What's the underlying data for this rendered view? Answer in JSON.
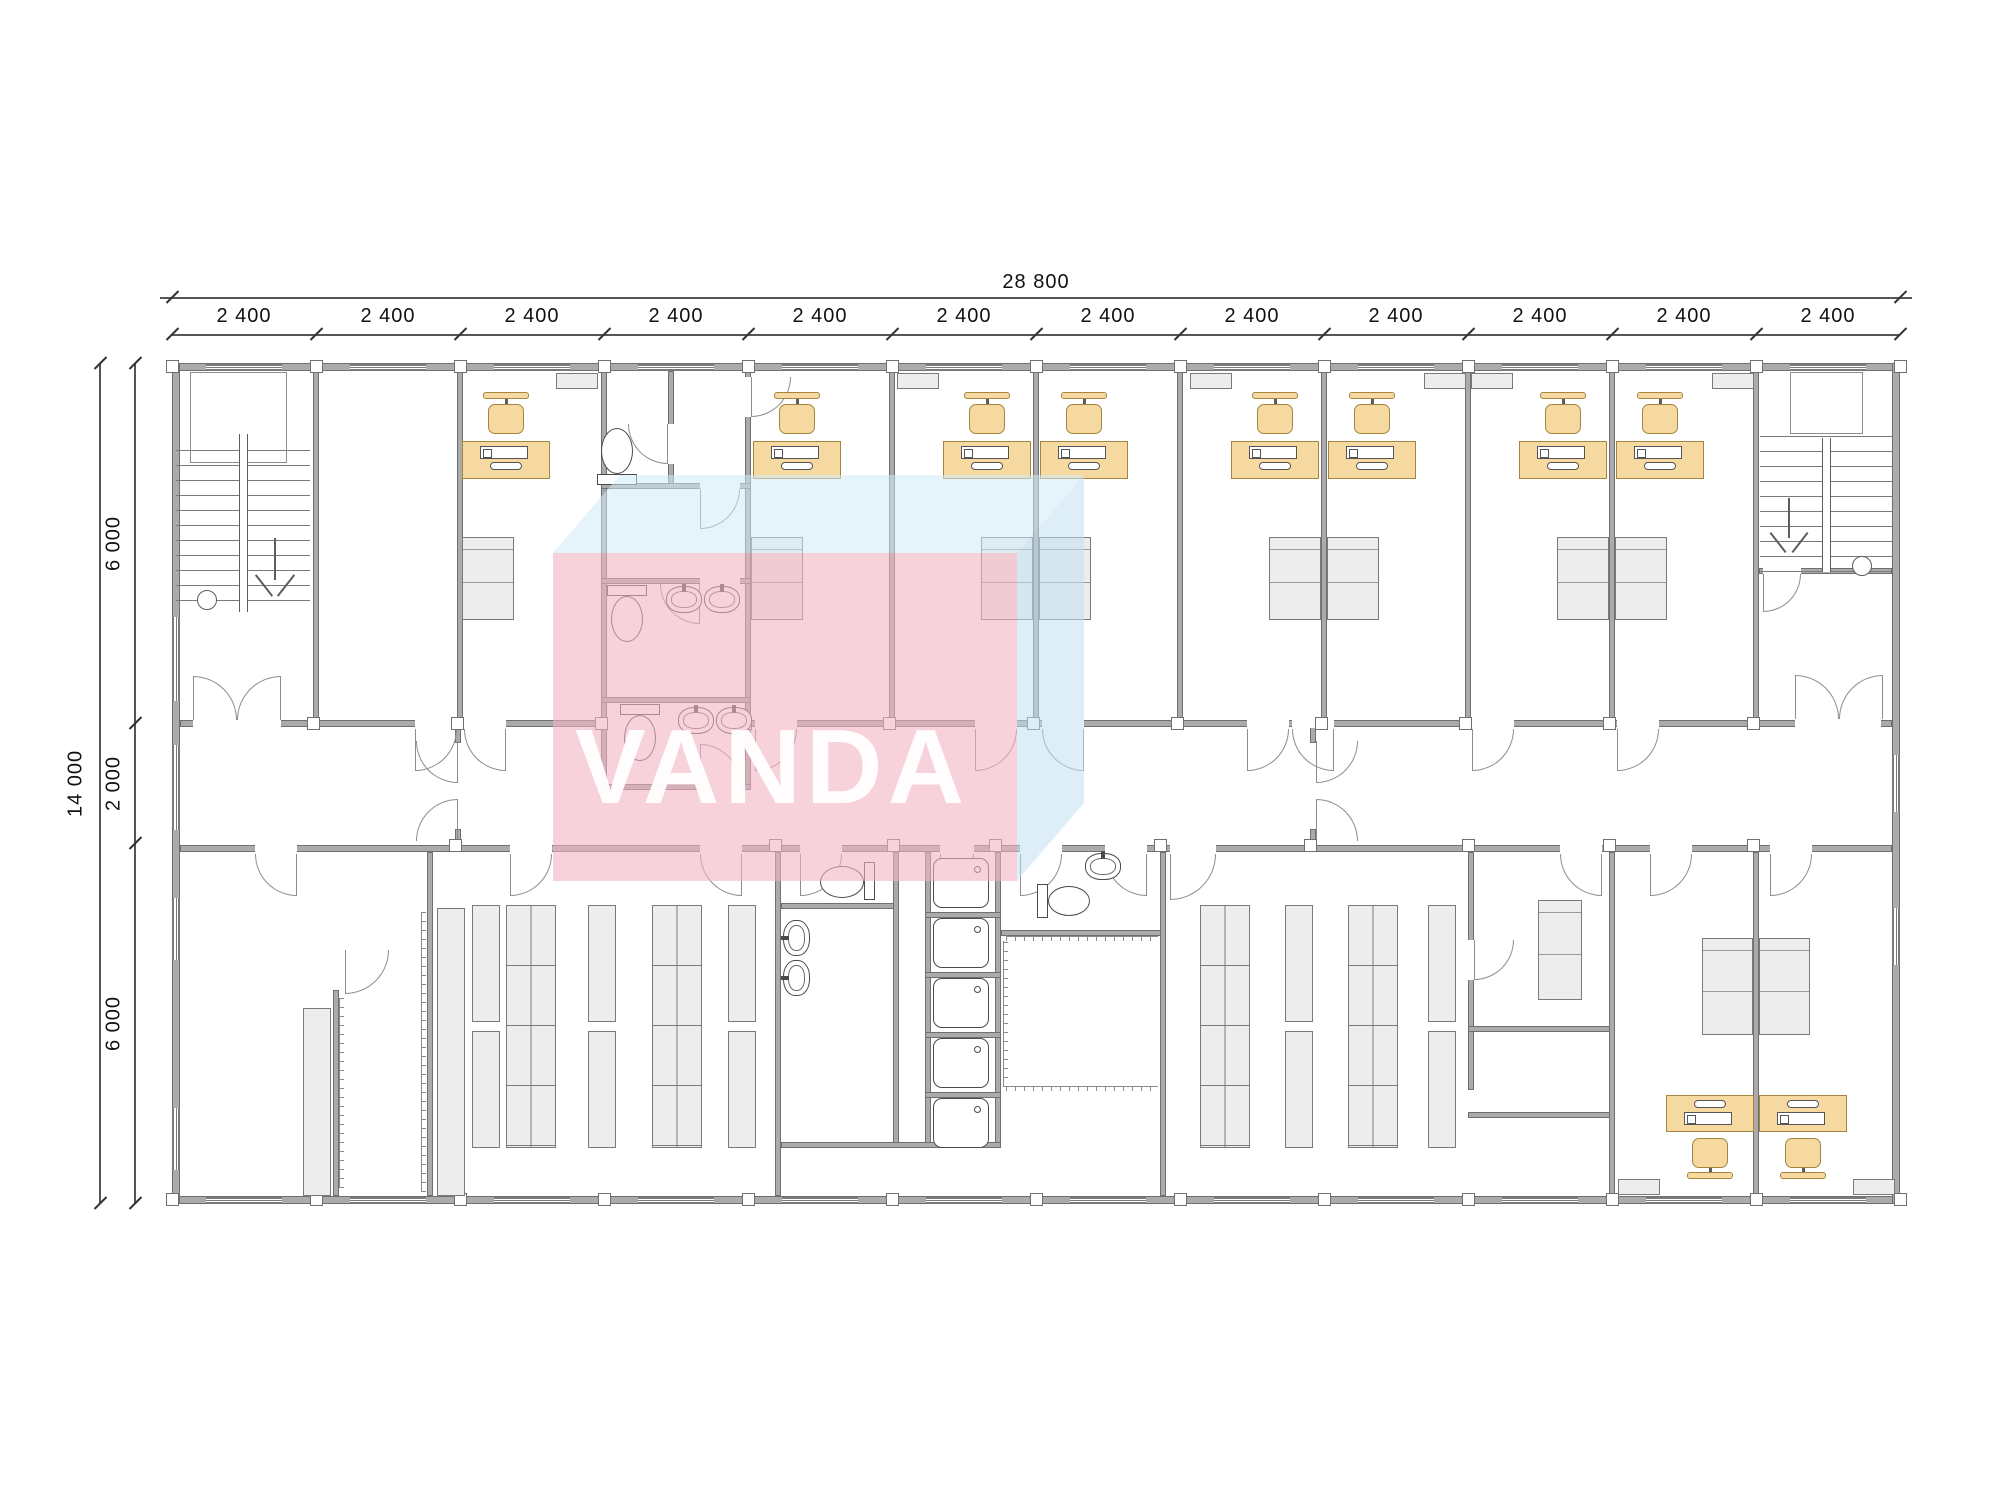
{
  "dimensions": {
    "total_width_label": "28 800",
    "width_segment_labels": [
      "2 400",
      "2 400",
      "2 400",
      "2 400",
      "2 400",
      "2 400",
      "2 400",
      "2 400",
      "2 400",
      "2 400",
      "2 400",
      "2 400"
    ],
    "total_height_label": "14 000",
    "height_segment_labels": [
      "6 000",
      "2 000",
      "6 000"
    ]
  },
  "watermark": {
    "text": "VANDA",
    "front_color": "#f3b4c2",
    "top_color": "#cfe9f7",
    "side_color": "#c3e0f2",
    "text_color": "#ffffff"
  },
  "colors": {
    "wall": "#ababab",
    "wall_edge": "#6f6f6f",
    "furniture_wood": "#f5d9a0",
    "furniture_wood_edge": "#a3853e",
    "furniture_gray": "#ededed",
    "fixture_line": "#4a4a4a",
    "dimension_text": "#111111"
  }
}
